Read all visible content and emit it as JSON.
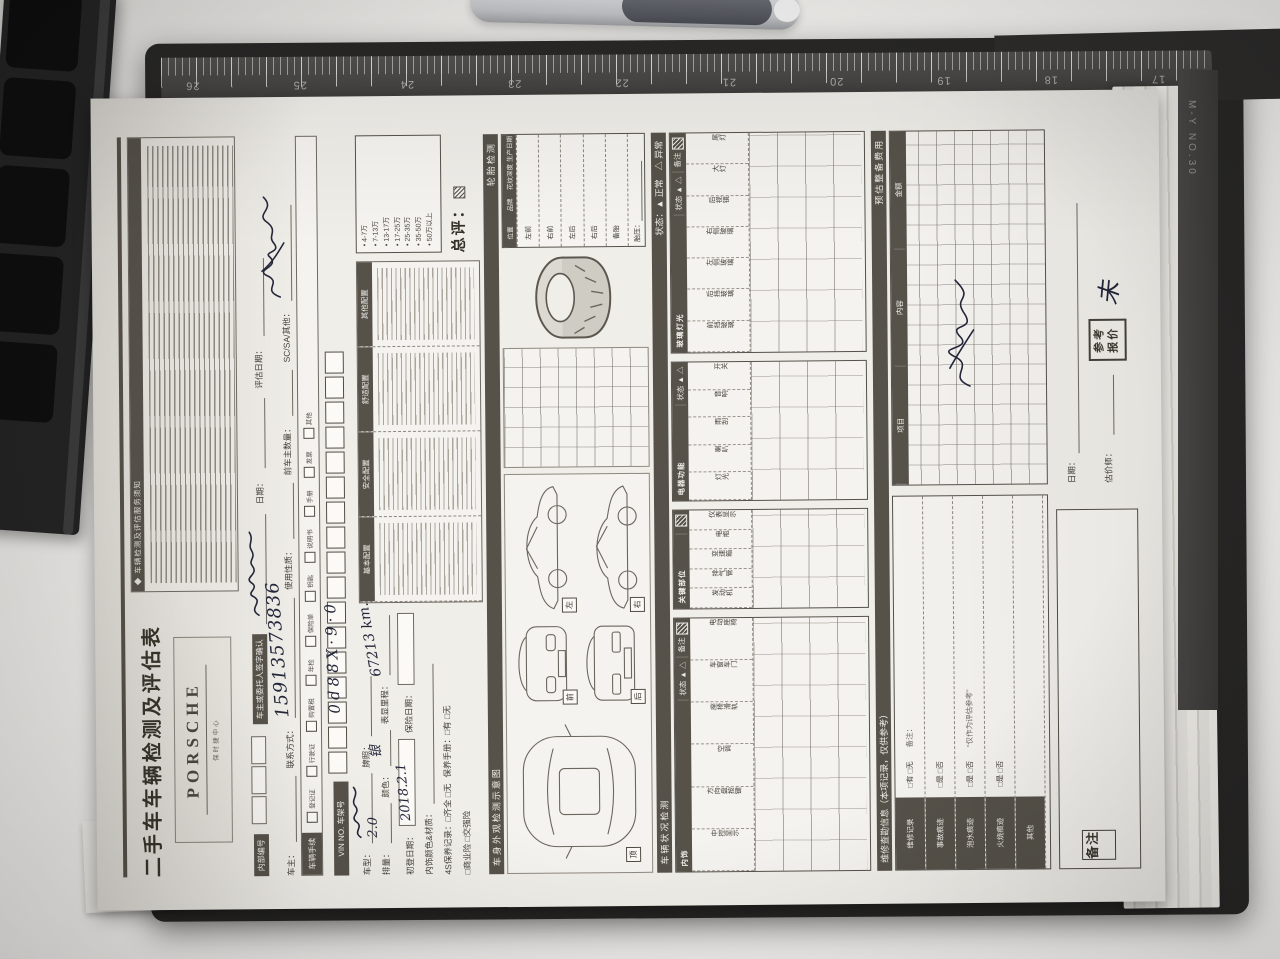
{
  "photo": {
    "desk_color": "#e6e5e2",
    "clipboard_color": "#272625",
    "paper_color": "#f0eee9",
    "band_color": "#56524a",
    "pen_ink_color": "#23263a",
    "ruler": {
      "numbers": [
        "17",
        "18",
        "19",
        "20",
        "21",
        "22",
        "23",
        "24",
        "25",
        "26"
      ],
      "brand": "M-Y NO.30"
    }
  },
  "form": {
    "title": "二手车车辆检测及评估表",
    "brand": {
      "name": "PORSCHE",
      "subtitle": "保时捷中心"
    },
    "terms": {
      "title": "◆ 车辆检测及评估服务须知"
    },
    "header_fields": {
      "internal_no_label": "内部编号",
      "confirm_label": "车主或委托人签字确认",
      "confirm_date_label": "日期：",
      "eval_date_label": "评估日期：",
      "owner_label": "车主：",
      "contact_label": "联系方式：",
      "contact_value": "15913573836",
      "usage_label": "使用性质：",
      "prev_owners_label": "前车主数量：",
      "sc_sa_label": "SC/SA/其他："
    },
    "vehicle_info": {
      "docs_label": "车辆手续",
      "docs_items": [
        "登记证",
        "行驶证",
        "购置税",
        "年检",
        "保险单",
        "钥匙",
        "说明书",
        "手册",
        "发票",
        "其他"
      ],
      "vin_label": "VIN NO. 车架号",
      "vin_value": "0d88X·9·0",
      "model_label": "车型：",
      "plate_label": "牌照：",
      "displacement_label": "排量：",
      "displacement_value": "2.0",
      "color_label": "颜色：",
      "color_value": "银",
      "mileage_label": "表显里程：",
      "mileage_value": "67213 km.",
      "reg_date_label": "初登日期：",
      "reg_date_value": "2018.2.1",
      "ins_date_label": "保险日期：",
      "interior_label": "内饰颜色&材质：",
      "maint_line": "4S保养记录：□齐全 □无",
      "booklet_line": "保养手册：□有 □无",
      "insurance_line": "□商业险 □交强险"
    },
    "config_table": {
      "columns": [
        "基本配置",
        "安全配置",
        "舒适配置",
        "其他配置"
      ]
    },
    "grade_box": {
      "items": [
        "4-7万",
        "7-13万",
        "13-17万",
        "17-25万",
        "25-35万",
        "35-50万",
        "50万以上"
      ],
      "overall_label": "总评："
    },
    "diagram": {
      "section_label": "车身外观检测示意图",
      "view_tags": [
        "顶",
        "前",
        "后",
        "左",
        "右"
      ]
    },
    "tire": {
      "section_label": "轮胎检测",
      "columns": [
        "位置",
        "品牌",
        "花纹深度",
        "生产日期"
      ],
      "rows": [
        "左前",
        "右前",
        "左后",
        "右后",
        "备胎"
      ],
      "pressure_label": "胎压："
    },
    "check_section": {
      "label": "车辆状况检测",
      "legend": "状态：▲ 正常　△ 异常"
    },
    "status_label": "状态",
    "status_marks": "▲ △",
    "note_label": "备注",
    "check_tables": [
      {
        "name": "内饰",
        "items": [
          "中控显示",
          "方向盘按键",
          "空调",
          "座椅滑轨",
          "车窗车门",
          "电动座椅"
        ]
      },
      {
        "name": "关键部位",
        "items": [
          "发动机",
          "排气管",
          "变速箱",
          "电瓶",
          "仪表显示"
        ]
      },
      {
        "name": "电器功能",
        "items": [
          "灯光",
          "喇叭",
          "雨刮",
          "音响",
          "开关"
        ]
      },
      {
        "name": "玻璃灯光",
        "items": [
          "前挡玻璃",
          "后挡玻璃",
          "左侧玻璃",
          "右侧玻璃",
          "后视镜",
          "大灯",
          "尾灯"
        ]
      }
    ],
    "repair": {
      "section_label": "维修查勘信息（本项记录，仅供参考）",
      "rows": [
        {
          "label": "维修记录",
          "opts": "□有 □无",
          "extra": "备注："
        },
        {
          "label": "事故痕迹",
          "opts": "□是 □否",
          "extra": ""
        },
        {
          "label": "泡水痕迹",
          "opts": "□是 □否",
          "extra": "“仅作为评估参考”"
        },
        {
          "label": "火烧痕迹",
          "opts": "□是 □否",
          "extra": ""
        },
        {
          "label": "其他",
          "opts": "",
          "extra": ""
        }
      ]
    },
    "cost_table": {
      "section_label": "预估整备费用",
      "columns": [
        "项目",
        "内容",
        "金额"
      ]
    },
    "footer": {
      "notes_label": "备注",
      "valuer_label": "估价师：",
      "quote_stamp_line1": "参考",
      "quote_stamp_line2": "报价",
      "quote_value": "未",
      "date_label": "日期："
    }
  }
}
